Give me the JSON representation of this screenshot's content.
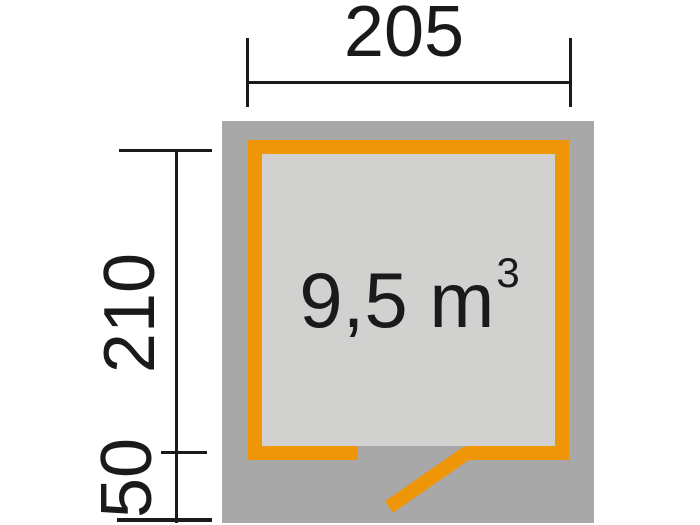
{
  "plan": {
    "title": "shed-floor-plan",
    "volume": {
      "text": "9,5 m",
      "superscript": "3",
      "full_label": "9,5 m³"
    },
    "dimensions": {
      "width": {
        "label": "205"
      },
      "depth": {
        "label": "210"
      },
      "front_overhang": {
        "label": "50"
      }
    },
    "colors": {
      "wall_accent": "#ee9608",
      "base_gray": "#a9a8a8",
      "floor_gray": "#d1d1d0",
      "dimension_ink": "#1a1a1a",
      "background": "#ffffff"
    }
  }
}
